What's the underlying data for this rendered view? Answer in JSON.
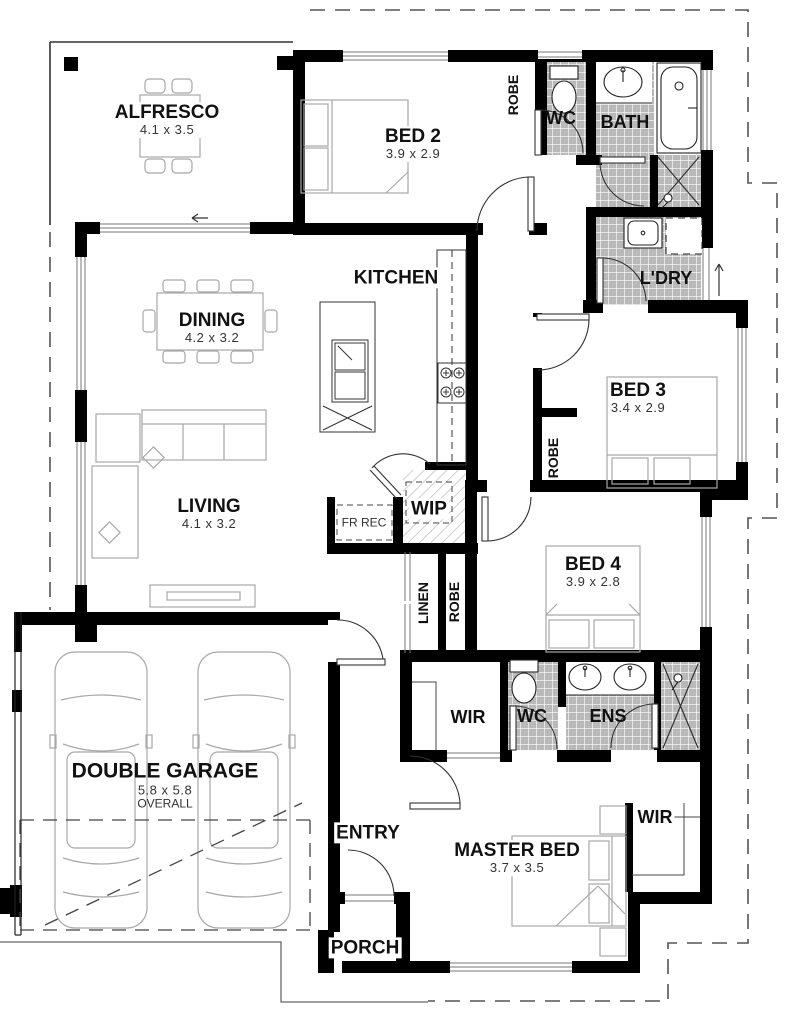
{
  "title": "Single storey house floor plan",
  "rooms": {
    "alfresco": {
      "label": "ALFRESCO",
      "dims": "4.1 x 3.5"
    },
    "bed2": {
      "label": "BED 2",
      "dims": "3.9 x 2.9"
    },
    "robe_bed2": {
      "label": "ROBE"
    },
    "wc": {
      "label": "WC"
    },
    "bath": {
      "label": "BATH"
    },
    "laundry": {
      "label": "L'DRY"
    },
    "kitchen": {
      "label": "KITCHEN"
    },
    "dining": {
      "label": "DINING",
      "dims": "4.2 x 3.2"
    },
    "bed3": {
      "label": "BED 3",
      "dims": "3.4 x 2.9"
    },
    "robe_bed3": {
      "label": "ROBE"
    },
    "living": {
      "label": "LIVING",
      "dims": "4.1 x 3.2"
    },
    "fridge_recess": {
      "label": "FR REC"
    },
    "pantry": {
      "label": "WIP"
    },
    "linen": {
      "label": "LINEN"
    },
    "robe_hall": {
      "label": "ROBE"
    },
    "bed4": {
      "label": "BED 4",
      "dims": "3.9 x 2.8"
    },
    "garage": {
      "label": "DOUBLE GARAGE",
      "dims": "5.8 x 5.8",
      "note": "OVERALL"
    },
    "wir_hall": {
      "label": "WIR"
    },
    "wc_ens": {
      "label": "WC"
    },
    "ens": {
      "label": "ENS"
    },
    "entry": {
      "label": "ENTRY"
    },
    "master": {
      "label": "MASTER BED",
      "dims": "3.7 x 3.5"
    },
    "wir_master": {
      "label": "WIR"
    },
    "porch": {
      "label": "PORCH"
    }
  },
  "colors": {
    "wall": "#000000",
    "tile_fill": "#b9b9b9",
    "tile_grid": "#ffffff",
    "boundary_dash": "#555555",
    "furniture_line": "#a8a8a8",
    "door_line": "#333333"
  }
}
